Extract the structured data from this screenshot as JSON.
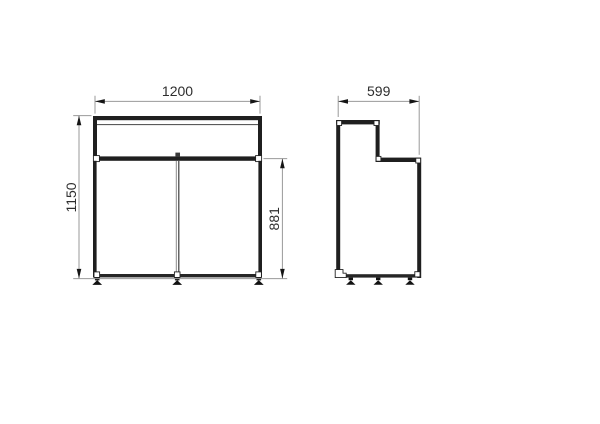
{
  "colors": {
    "background": "#ffffff",
    "structure_line": "#1f1f1f",
    "dimension_line": "#999999",
    "arrow": "#151515",
    "text": "#2e2e2e"
  },
  "views": {
    "front": {
      "dims": {
        "width": "1200",
        "height": "1150",
        "door_height": "881"
      }
    },
    "side": {
      "dims": {
        "depth": "599"
      }
    }
  }
}
